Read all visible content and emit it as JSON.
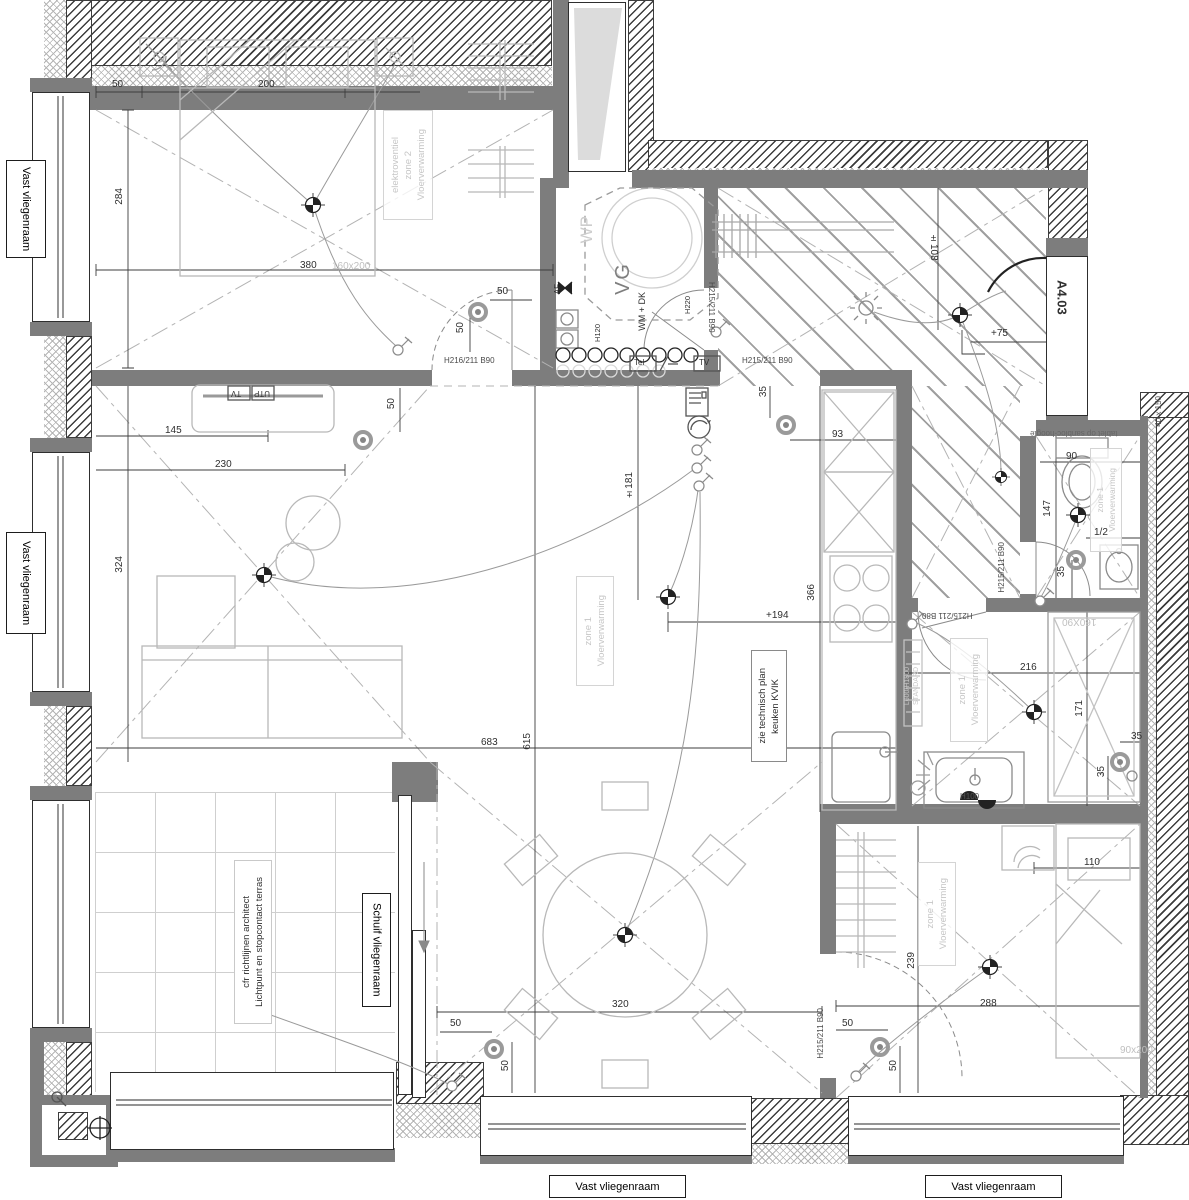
{
  "colors": {
    "wall": "#7d7d7d",
    "furniture_line": "#b8b8b8",
    "dim_text": "#2f2f2f",
    "note_text": "#c6c6c6"
  },
  "labels": {
    "vast": "Vast vliegenraam",
    "schuif": "Schuif vliegenraam",
    "a403": "A4.03",
    "niche": "40 x 150",
    "tablet": "tablet op sanbloc-hoogte",
    "zone2_l1": "Vloerverwarming",
    "zone2_l2": "zone 2",
    "zone2_l3": "elektroventiel",
    "zone1_l1": "Vloerverwarming",
    "zone1_l2": "zone 1",
    "kvik_l1": "keuken KVIK",
    "kvik_l2": "zie technisch plan",
    "terras_l1": "Lichtpunt en stopcontact terras",
    "terras_l2": "cfr richtlijnen architect",
    "radiator_l1": "STANDARD",
    "radiator_l2": "L600/H1800",
    "vg": "VG",
    "wp": "WP",
    "wmdk": "WM + DK",
    "af": "AF",
    "tel": "Tel",
    "tv": "TV",
    "utp": "UTP",
    "h120": "H120",
    "h220": "H220",
    "h100": "H100",
    "code_b1": "H216/211 B90",
    "code_90": "H215/211 B90",
    "code_80": "H215/211 B80",
    "bed1_size": "160x200",
    "bed2_size": "90x200",
    "shower_size": "160X90"
  },
  "dims": {
    "d50": "50",
    "d200": "200",
    "d284": "284",
    "d380": "380",
    "d145": "145",
    "d230": "230",
    "d324": "324",
    "d683": "683",
    "d615": "615",
    "d366": "366",
    "d93": "93",
    "d35": "35",
    "d108": "±108",
    "d75": "+75",
    "d181": "±181",
    "d194": "+194",
    "d90": "90",
    "d147": "147",
    "dhalf": "1/2",
    "d216": "216",
    "d171": "171",
    "d110": "110",
    "d239": "239",
    "d288": "288",
    "d320": "320"
  }
}
